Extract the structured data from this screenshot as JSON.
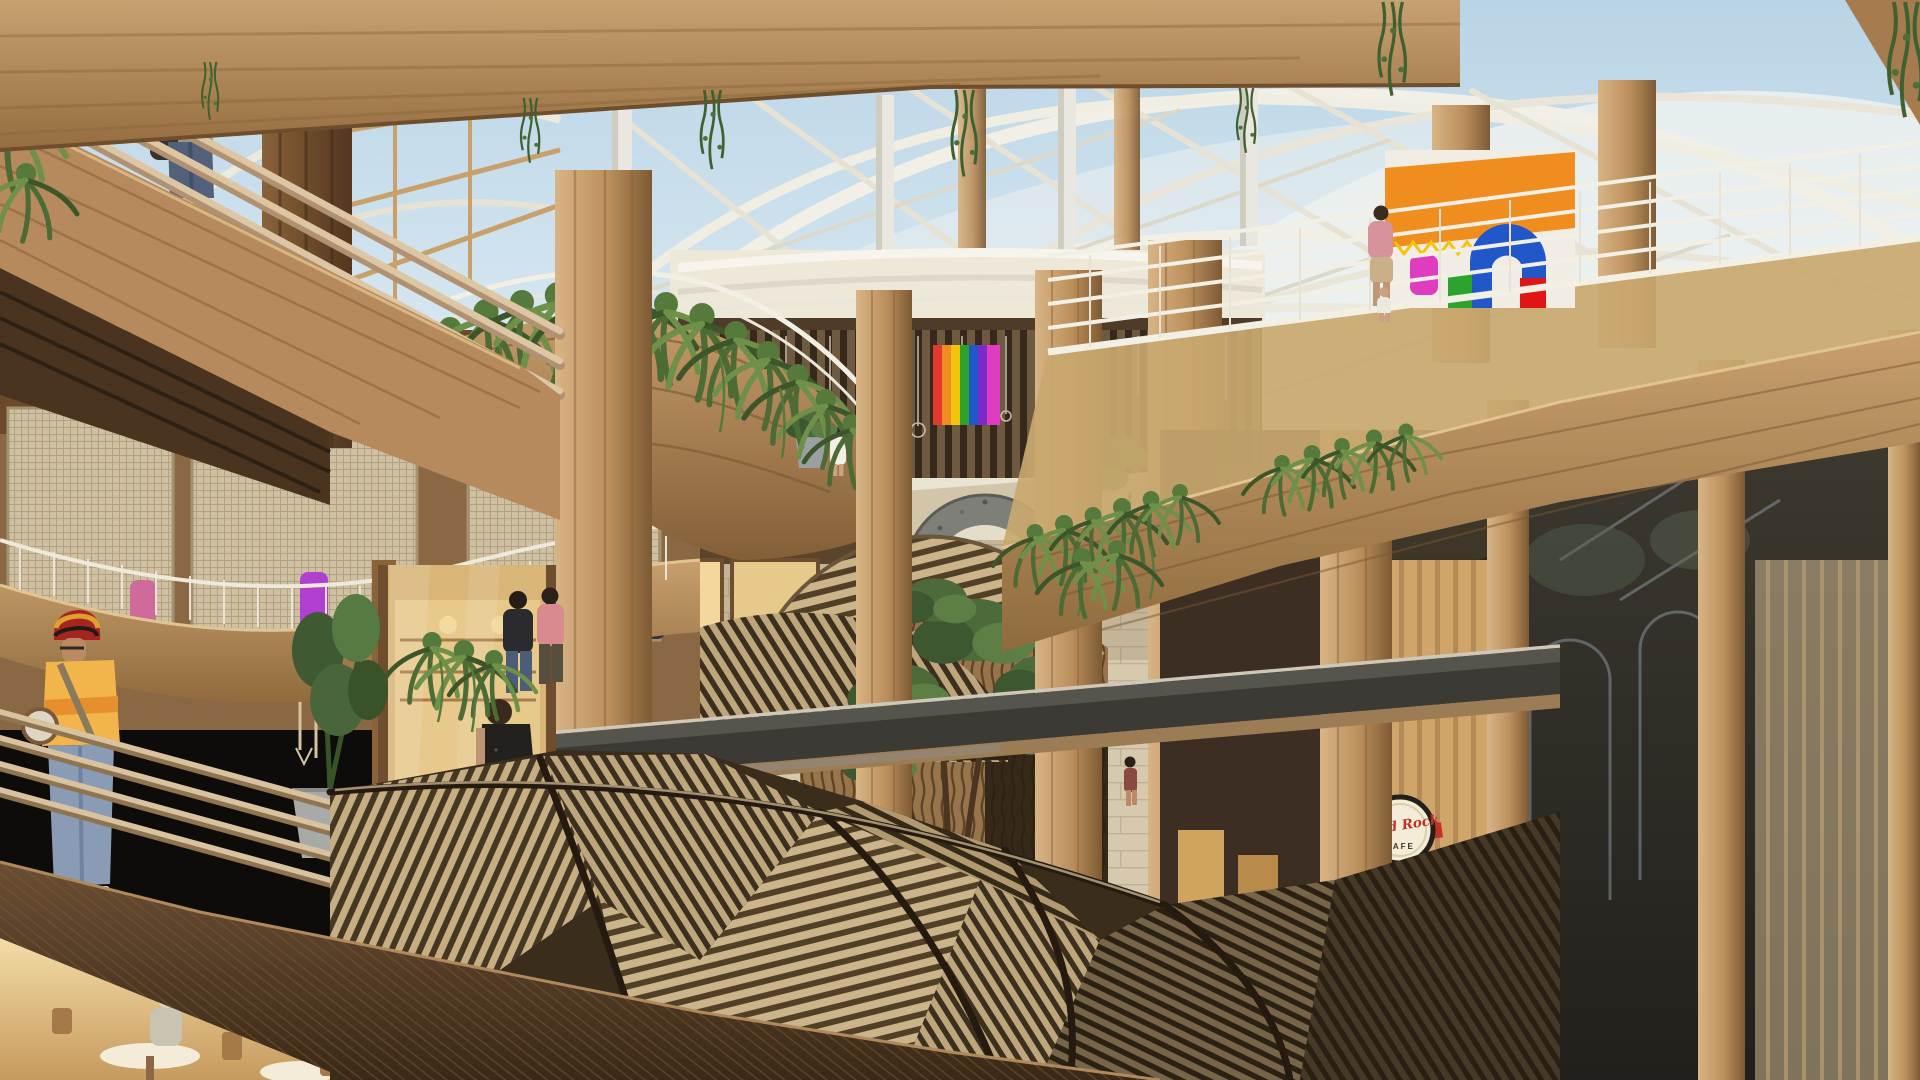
{
  "scene": {
    "type": "architectural-rendering",
    "title": "Timber shopping mall atrium rendering",
    "description": "Multi-level timber shopping centre atrium: curved white roof trusses over a skylight, wooden columns, curved balconies draped with hanging ferns, woven thatch canopies over a ground-floor stone promenade, a stone moon-gate arch in the distant plaza, shops and cafes on every level with shoppers throughout"
  },
  "signs": {
    "hard_rock_script": "Hard Rock",
    "hard_rock_cafe": "CAFE"
  },
  "palette": {
    "sky": "#bcd6e8",
    "truss_white": "#f2f0e6",
    "timber_light": "#cda678",
    "timber_mid": "#a87c4e",
    "walnut_dark": "#4e3823",
    "fern_green": "#4c6b35",
    "thatch_light": "#c6ad82",
    "thatch_dark": "#463723",
    "plaza_stone": "#d2c5aa",
    "glass_dark": "#2f2b24",
    "hard_rock_red": "#c23129",
    "shop_orange": "#ef8e1f",
    "shop_blue": "#2257c9",
    "shop_magenta": "#e03cc0"
  },
  "people": {
    "foreground_count": 16,
    "distant_count": 30
  }
}
